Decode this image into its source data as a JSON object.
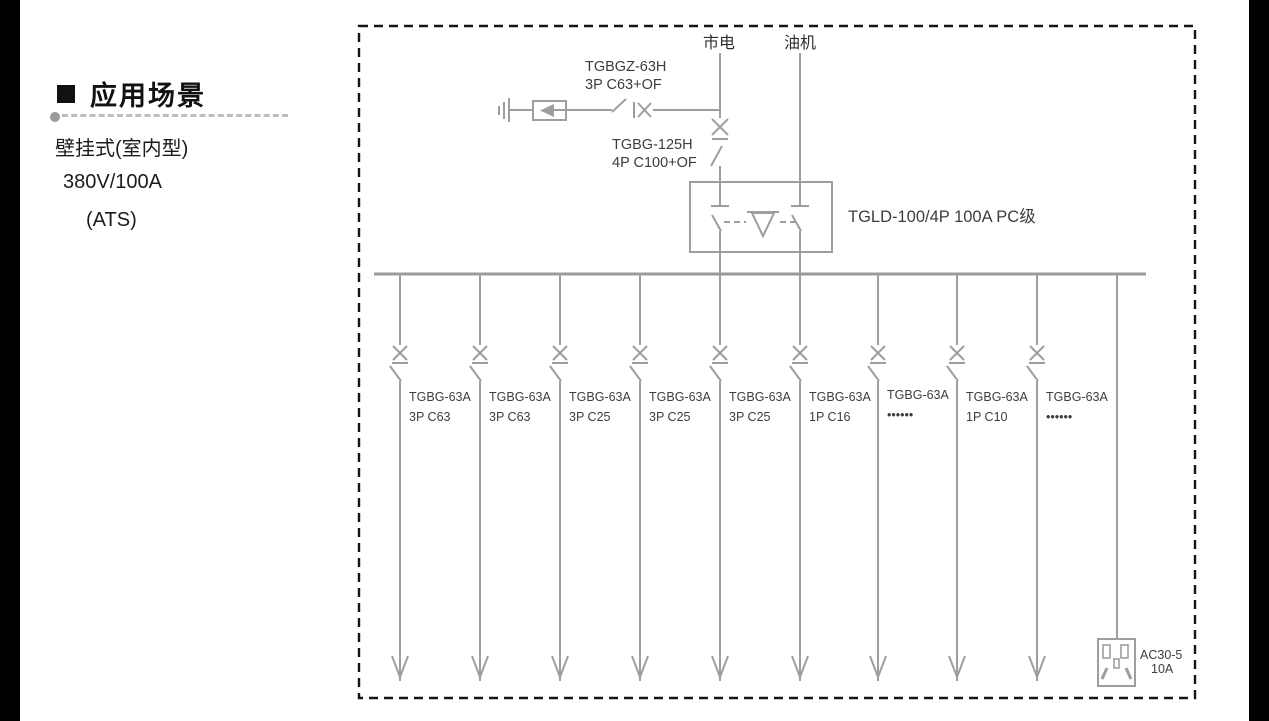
{
  "sidebar": {
    "title": "应用场景",
    "line1": "壁挂式(室内型)",
    "line2": "380V/100A",
    "line3": "(ATS)"
  },
  "diagram": {
    "source_left": "市电",
    "source_right": "油机",
    "spd_breaker": {
      "line1": "TGBGZ-63H",
      "line2": "3P C63+OF"
    },
    "main_breaker": {
      "line1": "TGBG-125H",
      "line2": "4P C100+OF"
    },
    "ats_label": "TGLD-100/4P 100A PC级",
    "branches": [
      {
        "model": "TGBG-63A",
        "spec": "3P C63"
      },
      {
        "model": "TGBG-63A",
        "spec": "3P C63"
      },
      {
        "model": "TGBG-63A",
        "spec": "3P C25"
      },
      {
        "model": "TGBG-63A",
        "spec": "3P C25"
      },
      {
        "model": "TGBG-63A",
        "spec": "3P C25"
      },
      {
        "model": "TGBG-63A",
        "spec": "1P C16"
      },
      {
        "model": "TGBG-63A",
        "spec": "••••••"
      },
      {
        "model": "TGBG-63A",
        "spec": "1P C10"
      },
      {
        "model": "TGBG-63A",
        "spec": "••••••"
      }
    ],
    "socket": {
      "line1": "AC30-5",
      "line2": "10A"
    }
  },
  "colors": {
    "diagram_line": "#9e9e9e",
    "diagram_text": "#3d3d3d",
    "heading_text": "#111111",
    "body_text": "#1c1c1c",
    "border_dash": "#151515",
    "divider": "#bdbdbd",
    "edge_bar": "#000000"
  }
}
